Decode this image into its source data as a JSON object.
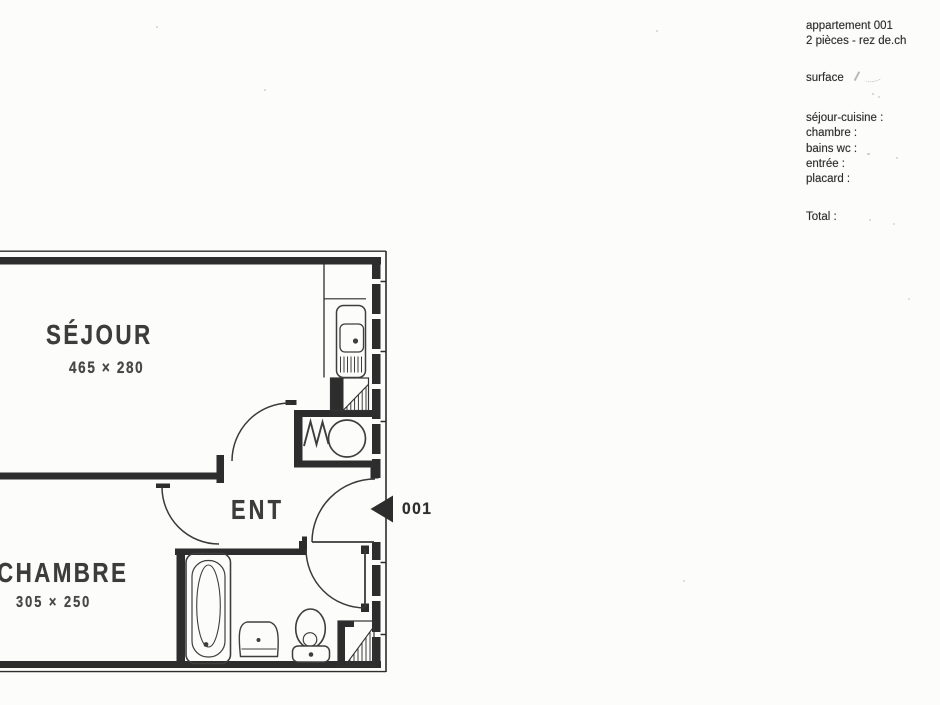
{
  "info_panel": {
    "title_line1": "appartement 001",
    "title_line2": "2 pièces - rez de.ch",
    "surface_label": "surface",
    "room_rows": [
      "séjour-cuisine :",
      "chambre :",
      "bains wc :",
      "entrée :",
      "placard :"
    ],
    "total_label": "Total :"
  },
  "plan": {
    "sejour": {
      "label": "SÉJOUR",
      "dims": "465 × 280"
    },
    "chambre": {
      "label": "CHAMBRE",
      "dims": "305 × 250"
    },
    "entree": {
      "label": "ENT"
    },
    "unit_number": "001",
    "ink_color": "#2d2d2d"
  }
}
